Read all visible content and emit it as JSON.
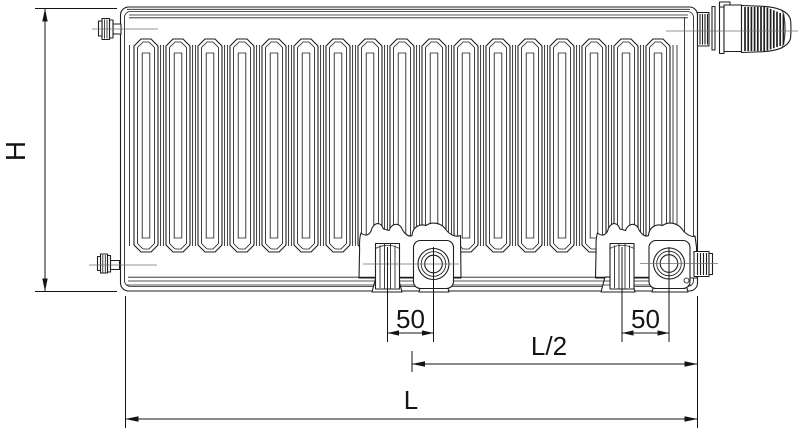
{
  "labels": {
    "height": "H",
    "spacing_left": "50",
    "spacing_right": "50",
    "half_length": "L/2",
    "length": "L"
  },
  "radiator": {
    "fin_count": 17
  },
  "colors": {
    "line": "#1f1f1f",
    "centerline": "#707070",
    "dimension": "#141414",
    "background": "#ffffff"
  }
}
